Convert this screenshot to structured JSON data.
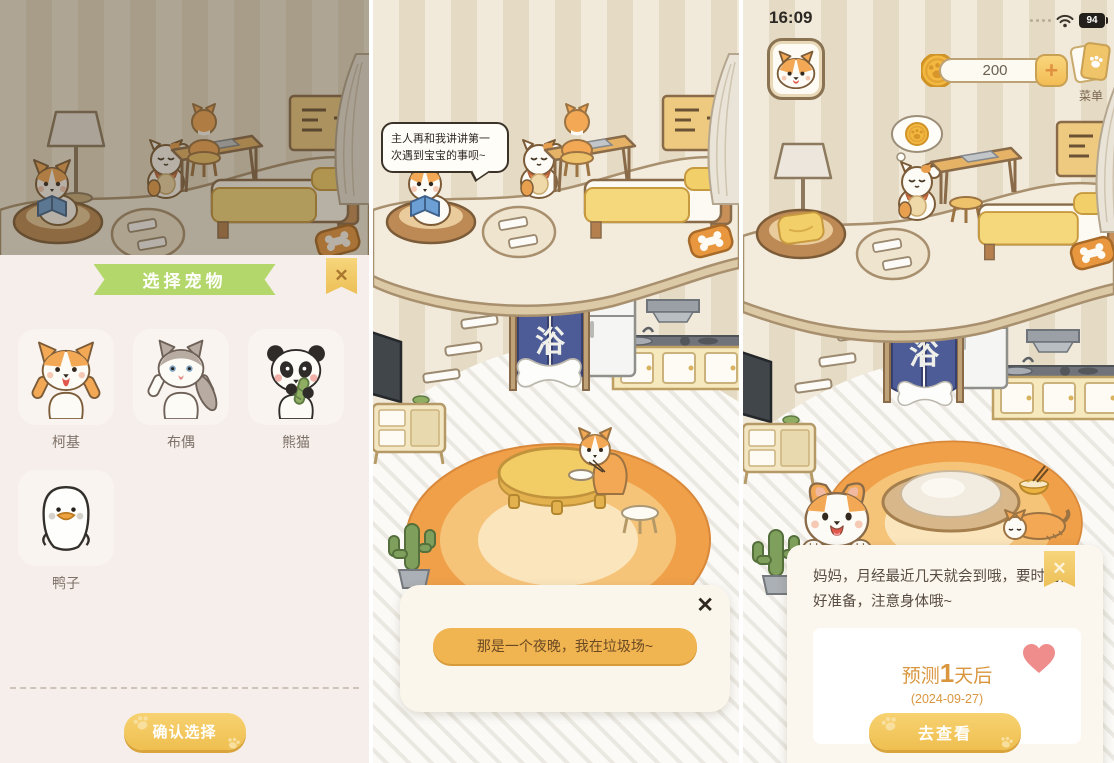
{
  "colors": {
    "accent_gold": "#f0c35f",
    "rug_orange": "#efa049",
    "ribbon_green": "#b3d76a",
    "heart_pink": "#ef8c8c",
    "noren_blue": "#4d5c96"
  },
  "screen1": {
    "modal": {
      "title": "选择宠物",
      "close_icon": "✕",
      "pets": [
        {
          "name": "柯基"
        },
        {
          "name": "布偶"
        },
        {
          "name": "熊猫"
        },
        {
          "name": "鸭子"
        }
      ],
      "confirm_button": "确认选择"
    }
  },
  "screen2": {
    "speech_bubble": "主人再和我讲讲第一次遇到宝宝的事呗~",
    "bath_sign": "浴",
    "dialog": {
      "close_icon": "✕",
      "story_button": "那是一个夜晚，我在垃圾场~"
    }
  },
  "screen3": {
    "status": {
      "time": "16:09",
      "battery": "94"
    },
    "hud": {
      "coin_amount": "200",
      "plus": "+",
      "menu_label": "菜单"
    },
    "bath_sign": "浴",
    "dialog": {
      "close_icon": "✕",
      "message": "妈妈，月经最近几天就会到哦，要时刻做好准备，注意身体哦~",
      "prediction_prefix": "预测",
      "prediction_number": "1",
      "prediction_suffix": "天后",
      "prediction_date": "(2024-09-27)",
      "action_button": "去查看"
    }
  }
}
